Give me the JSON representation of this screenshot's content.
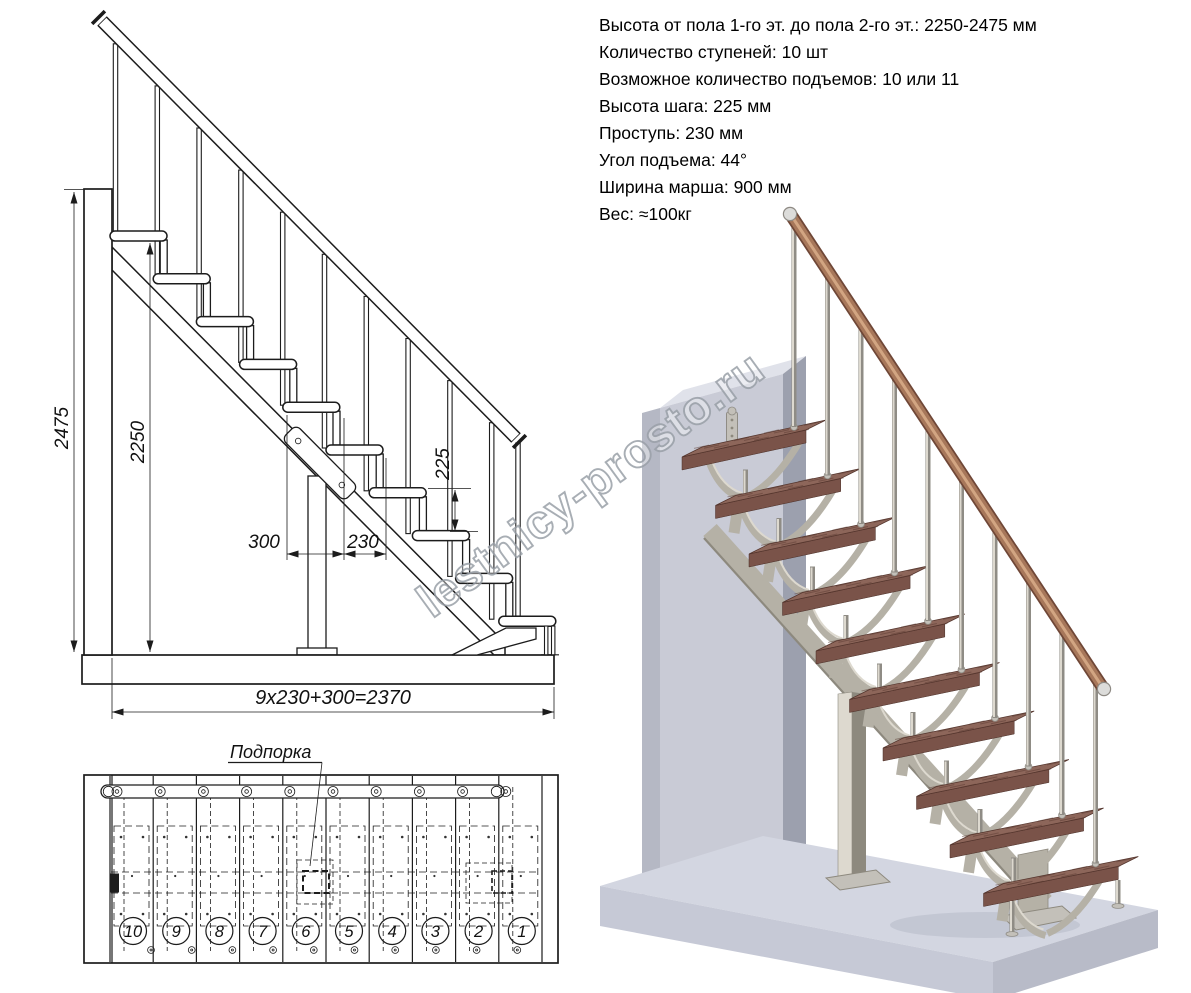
{
  "specs": {
    "lines": [
      "Высота от пола 1-го эт. до пола 2-го эт.: 2250-2475 мм",
      "Количество ступеней: 10 шт",
      "Возможное количество подъемов: 10 или 11",
      "Высота шага: 225 мм",
      "Проступь: 230 мм",
      "Угол подъема: 44°",
      "Ширина марша: 900 мм",
      "Вес: ≈100кг"
    ]
  },
  "side_view": {
    "dim_total_height": "2475",
    "dim_floor_to_top_step": "2250",
    "dim_rise": "225",
    "dim_tread_depth": "300",
    "dim_run": "230",
    "dim_total_run": "9x230+300=2370"
  },
  "plan_view": {
    "support_label": "Подпорка",
    "step_numbers": [
      "10",
      "9",
      "8",
      "7",
      "6",
      "5",
      "4",
      "3",
      "2",
      "1"
    ]
  },
  "watermark": "lestnicy-prosto.ru",
  "colors": {
    "line": "#1c1c1c",
    "tread_top": "#8d665a",
    "tread_front": "#7a5349",
    "tread_side": "#5d3c34",
    "tread_grain": "#57372e",
    "rail_dark": "#6f4737",
    "rail_core": "#a7775a",
    "rail_light": "#d7ab87",
    "metal": "#b5b1a6",
    "metal_dark": "#8d897e",
    "metal_light": "#ddd9cf",
    "silver": "#c3c0b9",
    "silver_edge": "#8f8c85",
    "wall_front": "#c9cbd6",
    "wall_left": "#b5b8c4",
    "wall_top": "#e0e2ea",
    "wall_right": "#9ca0ae",
    "floor_top": "#d3d6e1",
    "floor_front": "#c6c9d6",
    "floor_right": "#b8bbc8"
  }
}
